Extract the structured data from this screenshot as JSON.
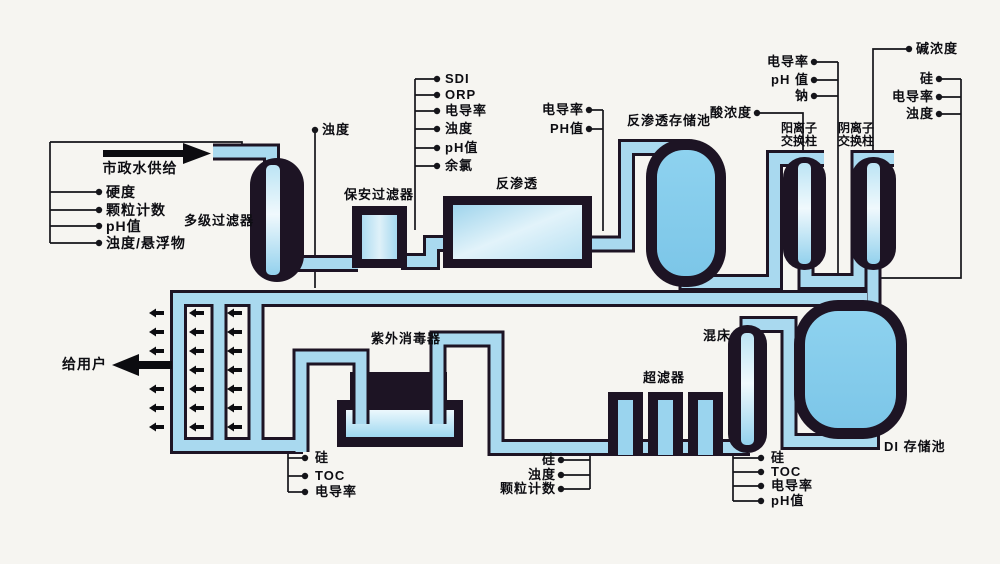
{
  "colors": {
    "background": "#f6f5f1",
    "pipe_fill": "#a9d9ef",
    "outline": "#1d1424",
    "tank_fill": "#84cbec",
    "ink": "#15151a"
  },
  "flow": {
    "supply": "市政水供给",
    "to_users": "给用户"
  },
  "equipment": {
    "multistage_filter": "多级过滤器",
    "security_filter": "保安过滤器",
    "reverse_osmosis": "反渗透",
    "ro_storage_tank": "反渗透存储池",
    "cation_exchange": [
      "阳离子",
      "交换柱"
    ],
    "anion_exchange": [
      "阴离子",
      "交换柱"
    ],
    "uv_sterilizer": "紫外消毒器",
    "ultrafilter": "超滤器",
    "mixed_bed": "混床",
    "di_storage_tank": "DI 存储池"
  },
  "monitors": {
    "feed": [
      "硬度",
      "颗粒计数",
      "pH值",
      "浊度/悬浮物"
    ],
    "filter_out": "浊度",
    "pre_ro": [
      "SDI",
      "ORP",
      "电导率",
      "浊度",
      "pH值",
      "余氯"
    ],
    "ro_out": [
      "电导率",
      "PH值"
    ],
    "acid": "酸浓度",
    "cation_out": [
      "电导率",
      "pH 值",
      "钠"
    ],
    "alkali": "碱浓度",
    "anion_out": [
      "硅",
      "电导率",
      "浊度"
    ],
    "uv_out": [
      "硅",
      "TOC",
      "电导率"
    ],
    "uf_out": [
      "硅",
      "浊度",
      "颗粒计数"
    ],
    "mixed_bed_out": [
      "硅",
      "TOC",
      "电导率",
      "pH值"
    ]
  }
}
